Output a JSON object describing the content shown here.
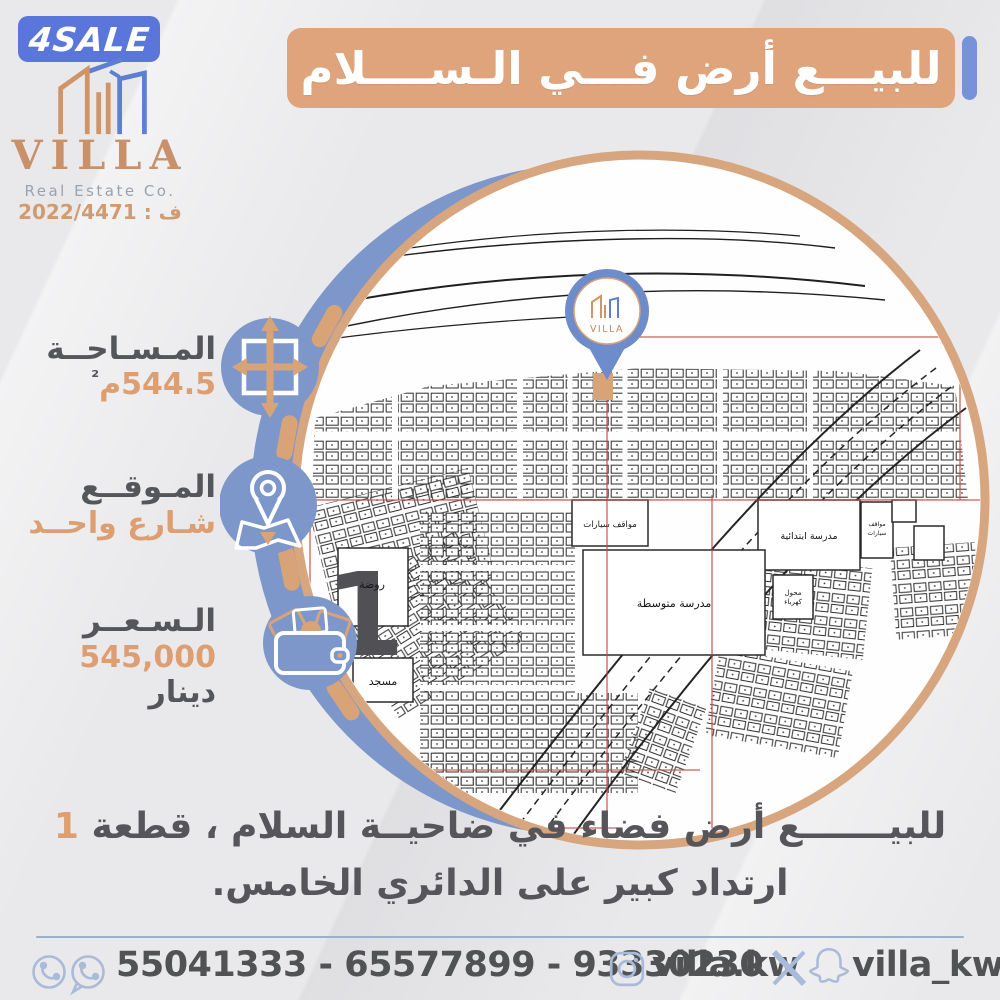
{
  "badge": {
    "text": "4SALE"
  },
  "brand": {
    "name": "VILLA",
    "tagline": "Real Estate Co.",
    "license": "ف : 2022/4471"
  },
  "banner": {
    "title": "للبيـــع أرض فـــي الـســــلام"
  },
  "specs": {
    "area": {
      "label": "المـسـاحــة",
      "value": "544.5م",
      "sup": "²"
    },
    "location": {
      "label": "المـوقــع",
      "value": "شـارع واحــد"
    },
    "price": {
      "label": "الـسـعــر",
      "value": "545,000",
      "unit": "دينار"
    }
  },
  "map": {
    "pin_brand": "VILLA",
    "labels": {
      "kindergarten": "روضة",
      "block_number": "1",
      "mosque": "مسجد",
      "middle_school": "مدرسة متوسطة",
      "primary_school": "مدرسة ابتدائية",
      "parking": "مواقف سيارات",
      "parking_word1": "مواقف",
      "parking_word2": "سيارات",
      "substation_word1": "محول",
      "substation_word2": "كهرباء"
    }
  },
  "description": {
    "line1_text": "للبيـــــــع أرض فضاء في ضاحيــة السلام ، قطعة",
    "line1_number": "1",
    "line2": "ارتداد كبير على الدائري الخامس."
  },
  "footer": {
    "phones": "55041333 - 65577899 - 93330230",
    "instagram_handle": "villa.kw",
    "social_handle": "villa_kw"
  },
  "colors": {
    "copper": "#dca176",
    "ring": "#d7a67e",
    "badge_blue": "#5b76da",
    "icon_blue": "#7e97cb",
    "dark_text": "#55565a",
    "footer_icon": "#a9bbd8",
    "grid_red": "#c2473b",
    "map_bg": "#fefefe"
  }
}
